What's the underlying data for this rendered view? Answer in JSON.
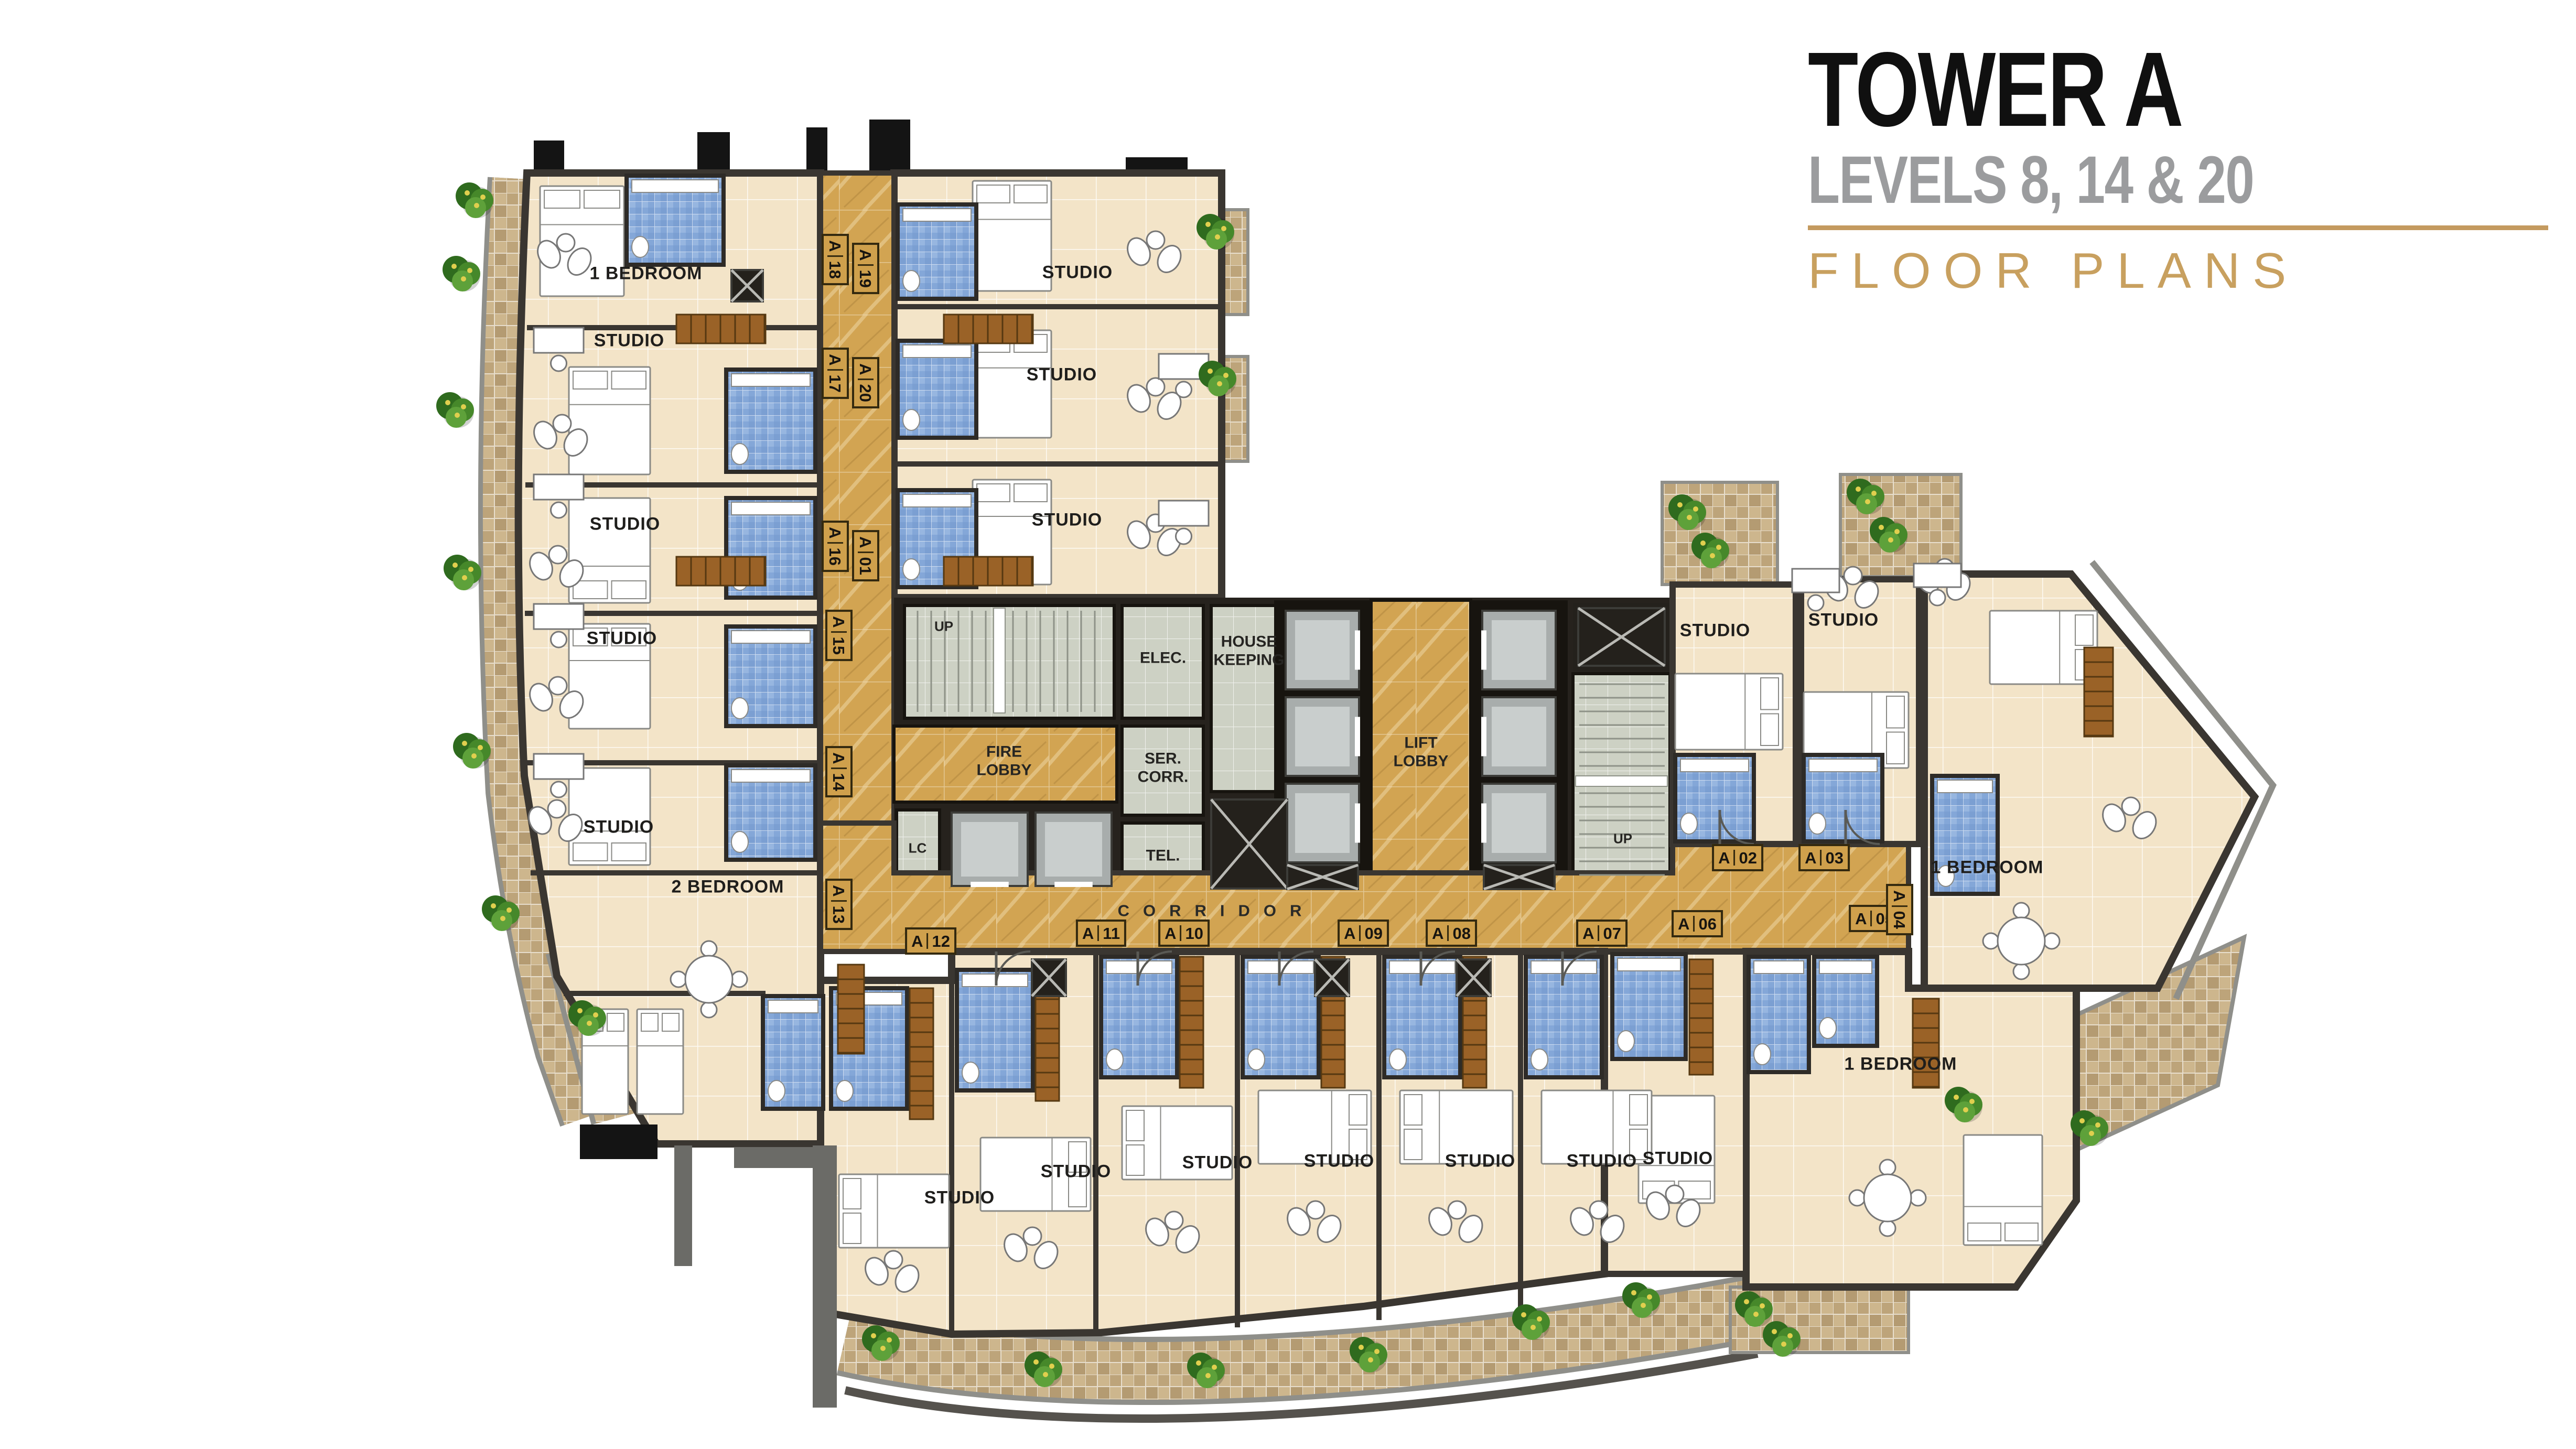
{
  "title_block": {
    "title": "TOWER A",
    "subtitle": "LEVELS 8, 14 & 20",
    "caption": "FLOOR PLANS"
  },
  "colors": {
    "accent_gold": "#c49a5f",
    "subtitle_gray": "#9b9c9e",
    "corridor_marble": "#d2a452",
    "unit_floor": "#f3e4c8",
    "bathroom_blue": "#84a7d8",
    "service_gray": "#cdd1c4",
    "balcony_tan": "#cdb68d",
    "wall_dark": "#3a3631",
    "tag_gold": "#cfa04c",
    "plant_green": "#46882a"
  },
  "rooms": {
    "one_bedroom_top_left": "1 BEDROOM",
    "studio_left_1": "STUDIO",
    "studio_left_2": "STUDIO",
    "studio_left_3": "STUDIO",
    "studio_left_4": "STUDIO",
    "two_bedroom": "2 BEDROOM",
    "studio_upper_1": "STUDIO",
    "studio_upper_2": "STUDIO",
    "studio_upper_3": "STUDIO",
    "studio_right_1": "STUDIO",
    "studio_right_2": "STUDIO",
    "one_bedroom_right": "1 BEDROOM",
    "one_bedroom_bottom": "1 BEDROOM",
    "studio_bottom_right": "STUDIO",
    "studio_bottom_1": "STUDIO",
    "studio_bottom_2": "STUDIO",
    "studio_bottom_3": "STUDIO",
    "studio_bottom_4": "STUDIO",
    "studio_bottom_5": "STUDIO",
    "studio_bottom_6": "STUDIO"
  },
  "core": {
    "up_left": "UP",
    "electrical": "ELEC.",
    "housekeeping": "HOUSE\nKEEPING",
    "fire_lobby": "FIRE\nLOBBY",
    "service_corridor": "SER.\nCORR.",
    "luggage_closet": "LC",
    "telephone": "TEL.",
    "lift_lobby": "LIFT\nLOBBY",
    "up_right": "UP",
    "corridor": "CORRIDOR"
  },
  "unit_tags": [
    {
      "prefix": "A",
      "number": "18"
    },
    {
      "prefix": "A",
      "number": "19"
    },
    {
      "prefix": "A",
      "number": "17"
    },
    {
      "prefix": "A",
      "number": "20"
    },
    {
      "prefix": "A",
      "number": "16"
    },
    {
      "prefix": "A",
      "number": "01"
    },
    {
      "prefix": "A",
      "number": "15"
    },
    {
      "prefix": "A",
      "number": "14"
    },
    {
      "prefix": "A",
      "number": "13"
    },
    {
      "prefix": "A",
      "number": "12"
    },
    {
      "prefix": "A",
      "number": "11"
    },
    {
      "prefix": "A",
      "number": "10"
    },
    {
      "prefix": "A",
      "number": "09"
    },
    {
      "prefix": "A",
      "number": "08"
    },
    {
      "prefix": "A",
      "number": "07"
    },
    {
      "prefix": "A",
      "number": "06"
    },
    {
      "prefix": "A",
      "number": "05"
    },
    {
      "prefix": "A",
      "number": "04"
    },
    {
      "prefix": "A",
      "number": "03"
    },
    {
      "prefix": "A",
      "number": "02"
    }
  ]
}
